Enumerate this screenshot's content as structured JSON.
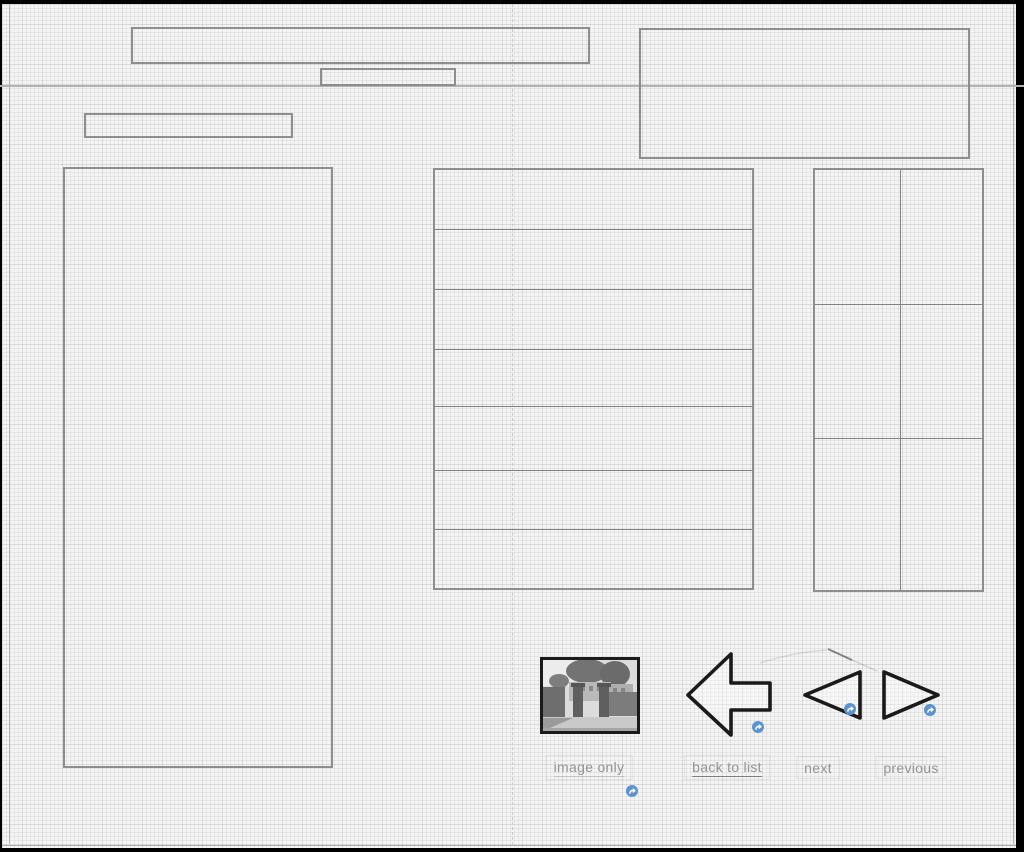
{
  "nav": {
    "image_only": {
      "label": "image only"
    },
    "back_to_list": {
      "label": "back to list"
    },
    "next": {
      "label": "next"
    },
    "previous": {
      "label": "previous"
    }
  },
  "icons": {
    "link_badge": "curved-link-arrow",
    "back_to_list_arrow": "left-block-arrow",
    "next_arrow": "left-triangle",
    "previous_arrow": "right-triangle",
    "thumbnail": "grayscale-photo-of-gate-entrance"
  },
  "colors": {
    "accent_blue": "#5b93cf",
    "sketch_black": "#1a1a1a",
    "wire_border_gray": "#8e8e8e",
    "label_gray": "#949494",
    "paper_gray": "#f4f4f4"
  }
}
